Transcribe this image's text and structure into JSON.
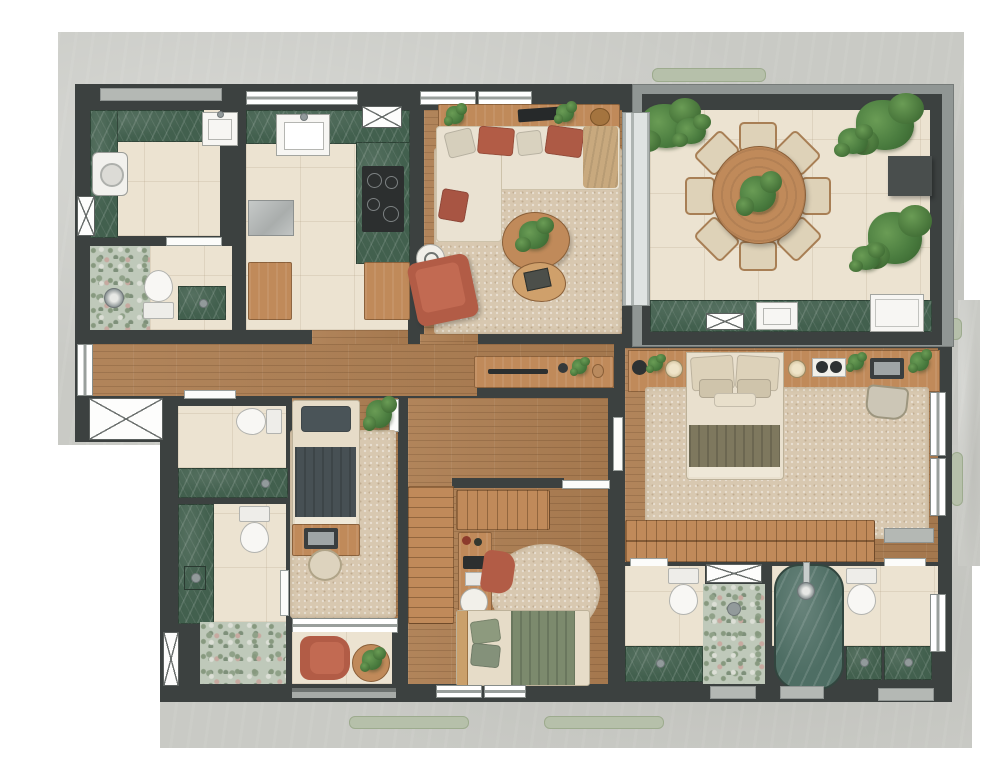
{
  "meta": {
    "title": "apartment-floor-plan-top-view",
    "text_labels": []
  },
  "canvas": {
    "width": 1000,
    "height": 781
  },
  "palette": {
    "wall": "#3c4140",
    "concrete": "#c9cac5",
    "tile": "#ece3d1",
    "wood": "#ad7e52",
    "wood_furn": "#c08a5a",
    "marble": "#42604e",
    "rug": "#d8c8b0",
    "sofa": "#eae2d2",
    "terracotta": "#b25c46",
    "slate": "#4a5458",
    "olive": "#7e785e",
    "green_bed": "#7c8a6d",
    "plant": "#4a7c3f",
    "plant_light": "#6a9c55",
    "plant_dark": "#35602c",
    "sage": "#b6c0aa",
    "white_fix": "#f7f6f3",
    "gray_frame": "#909694",
    "dark_box": "#494e4d",
    "tan": "#c8a97e",
    "cream_pillow": "#e6dcc8",
    "tub": "#4e6e64"
  },
  "symbols": {
    "shaft": "x-hatch-box",
    "vent": "x-hatch-box",
    "window": "double-line-strip",
    "door": "white-leaf"
  },
  "rooms": [
    "laundry",
    "wc",
    "kitchen",
    "living-room",
    "terrace-dining",
    "hallway",
    "bathroom-1",
    "bathroom-2",
    "bedroom-1",
    "balcony",
    "bedroom-2",
    "master-bedroom",
    "bathroom-3",
    "bathroom-4"
  ]
}
